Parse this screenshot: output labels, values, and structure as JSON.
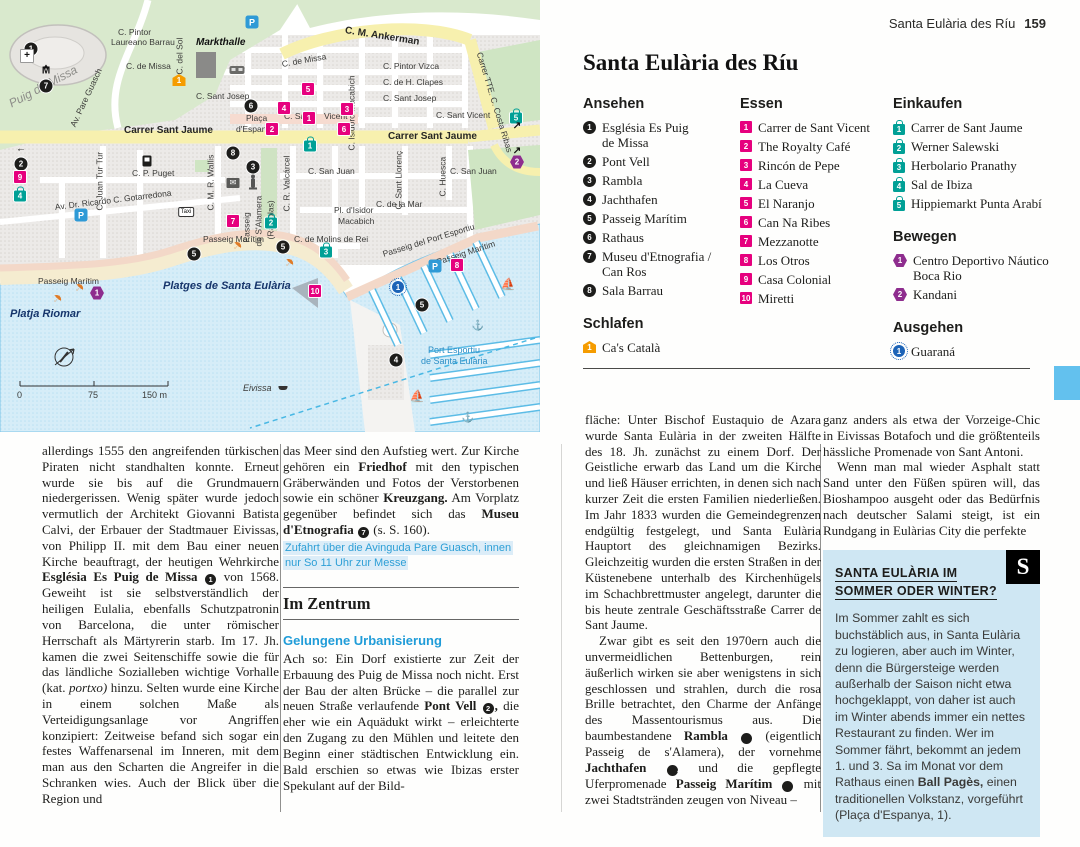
{
  "header": {
    "title": "Santa Eulària des Ríu",
    "page": "159"
  },
  "section_title": "Santa Eulària des Ríu",
  "colors": {
    "sight": "#1d1d1b",
    "food": "#e6007e",
    "shop": "#00a096",
    "sleep": "#f59c00",
    "move": "#8e2d8e",
    "go": "#1c63b7",
    "heading_blue": "#1f9cd8",
    "box_bg": "#cfe7f3",
    "edge_tab": "#63c1ee",
    "street_yellow": "#f7f0ae"
  },
  "lists": {
    "ansehen": {
      "title": "Ansehen",
      "type": "sight",
      "items": [
        {
          "n": "1",
          "lines": [
            "Església Es Puig",
            "de Missa"
          ]
        },
        {
          "n": "2",
          "lines": [
            "Pont Vell"
          ]
        },
        {
          "n": "3",
          "lines": [
            "Rambla"
          ]
        },
        {
          "n": "4",
          "lines": [
            "Jachthafen"
          ]
        },
        {
          "n": "5",
          "lines": [
            "Passeig Marítim"
          ]
        },
        {
          "n": "6",
          "lines": [
            "Rathaus"
          ]
        },
        {
          "n": "7",
          "lines": [
            "Museu d'Etnografia /",
            "Can Ros"
          ]
        },
        {
          "n": "8",
          "lines": [
            "Sala Barrau"
          ]
        }
      ]
    },
    "essen": {
      "title": "Essen",
      "type": "food",
      "items": [
        {
          "n": "1",
          "lines": [
            "Carrer de Sant Vicent"
          ]
        },
        {
          "n": "2",
          "lines": [
            "The Royalty Café"
          ]
        },
        {
          "n": "3",
          "lines": [
            "Rincón de Pepe"
          ]
        },
        {
          "n": "4",
          "lines": [
            "La Cueva"
          ]
        },
        {
          "n": "5",
          "lines": [
            "El Naranjo"
          ]
        },
        {
          "n": "6",
          "lines": [
            "Can Na Ribes"
          ]
        },
        {
          "n": "7",
          "lines": [
            "Mezzanotte"
          ]
        },
        {
          "n": "8",
          "lines": [
            "Los Otros"
          ]
        },
        {
          "n": "9",
          "lines": [
            "Casa Colonial"
          ]
        },
        {
          "n": "10",
          "lines": [
            "Miretti"
          ]
        }
      ]
    },
    "einkaufen": {
      "title": "Einkaufen",
      "type": "shop",
      "items": [
        {
          "n": "1",
          "lines": [
            "Carrer de Sant Jaume"
          ]
        },
        {
          "n": "2",
          "lines": [
            "Werner Salewski"
          ]
        },
        {
          "n": "3",
          "lines": [
            "Herbolario Pranathy"
          ]
        },
        {
          "n": "4",
          "lines": [
            "Sal de Ibiza"
          ]
        },
        {
          "n": "5",
          "lines": [
            "Hippiemarkt Punta Arabí"
          ]
        }
      ]
    },
    "schlafen": {
      "title": "Schlafen",
      "type": "sleep",
      "items": [
        {
          "n": "1",
          "lines": [
            "Ca's Català"
          ]
        }
      ]
    },
    "bewegen": {
      "title": "Bewegen",
      "type": "move",
      "items": [
        {
          "n": "1",
          "lines": [
            "Centro Deportivo Náutico",
            "Boca Rio"
          ]
        },
        {
          "n": "2",
          "lines": [
            "Kandani"
          ]
        }
      ]
    },
    "ausgehen": {
      "title": "Ausgehen",
      "type": "go",
      "items": [
        {
          "n": "1",
          "lines": [
            "Guaraná"
          ]
        }
      ]
    }
  },
  "body": {
    "col1": [
      {
        "t": "allerdings 1555 den angreifenden türkischen Piraten nicht standhalten konnte. Erneut wurde sie bis auf die Grundmauern niedergerissen. Wenig später wurde jedoch vermutlich der Architekt Giovanni Batista Calvi, der Erbauer der Stadtmauer Eivissas, von Philipp II. mit dem Bau einer neuen Kirche beauftragt, der heutigen Wehrkirche "
      },
      {
        "t": "Església Es Puig de Missa",
        "b": 1
      },
      {
        "t": " "
      },
      {
        "badge": "1"
      },
      {
        "t": " von 1568. Geweiht ist sie selbstverständlich der heiligen Eulalia, ebenfalls Schutzpatronin von Barcelona, die unter römischer Herrschaft als Märtyrerin starb. Im 17. Jh. kamen die zwei Seitenschiffe sowie die für das ländliche Sozialleben wichtige Vorhalle (kat. "
      },
      {
        "t": "portxo)",
        "i": 1
      },
      {
        "t": " hinzu. Selten wurde eine Kirche in einem solchen Maße als Verteidigungsanlage vor Angriffen konzipiert: Zeitweise befand sich sogar ein festes Waffenarsenal im Inneren, mit dem man aus den Scharten die Angreifer in die Schranken wies. Auch der Blick über die Region und"
      }
    ],
    "col2_para1": [
      {
        "t": "das Meer sind den Aufstieg wert. Zur Kirche gehören ein "
      },
      {
        "t": "Friedhof",
        "b": 1
      },
      {
        "t": " mit den typischen Gräberwänden und Fotos der Verstorbenen sowie ein schöner "
      },
      {
        "t": "Kreuzgang.",
        "b": 1
      },
      {
        "t": " Am Vorplatz gegenüber befindet sich das "
      },
      {
        "t": "Museu d'Etnografia",
        "b": 1
      },
      {
        "t": " "
      },
      {
        "badge": "7"
      },
      {
        "t": " (s. S. 160)."
      }
    ],
    "col2_info": "Zufahrt über die Avinguda Pare Guasch, innen nur So 11 Uhr zur Messe",
    "col2_heading": "Im Zentrum",
    "col2_subheading": "Gelungene Urbanisierung",
    "col2_para2": [
      {
        "t": "Ach so: Ein Dorf existierte zur Zeit der Erbauung des Puig de Missa noch nicht. Erst der Bau der alten Brücke – die parallel zur neuen Straße verlaufende "
      },
      {
        "t": "Pont Vell",
        "b": 1
      },
      {
        "t": " "
      },
      {
        "badge": "2"
      },
      {
        "t": ",",
        "b": 1
      },
      {
        "t": " die eher wie ein Aquädukt wirkt – erleichterte den Zugang zu den Mühlen und leitete den Beginn einer städtischen Entwicklung ein. Bald erschien so etwas wie Ibizas erster Spekulant auf der Bild-"
      }
    ],
    "col3_para1": [
      {
        "t": "fläche: Unter Bischof Eustaquio de Azara wurde Santa Eulària in der zweiten Hälfte des 18. Jh. zunächst zu einem Dorf. Der Geistliche erwarb das Land um die Kirche und ließ Häuser errichten, in denen sich nach kurzer Zeit die ersten Familien niederließen. Im Jahr 1833 wurden die Gemeindegrenzen endgültig festgelegt, und Santa Eulària Hauptort des gleichnamigen Bezirks. Gleichzeitig wurden die ersten Straßen in der Küstenebene unterhalb des Kirchenhügels im Schachbrettmuster angelegt, darunter die bis heute zentrale Geschäftsstraße Carrer de Sant Jaume."
      }
    ],
    "col3_para2": [
      {
        "t": "Zwar gibt es seit den 1970ern auch die unvermeidlichen Bettenburgen, rein äußerlich wirken sie aber wenigstens in sich geschlossen und strahlen, durch die rosa Brille betrachtet, den Charme der Anfänge des Massentourismus aus. Die baumbestandene "
      },
      {
        "t": "Rambla",
        "b": 1
      },
      {
        "t": " "
      },
      {
        "badge": "3"
      },
      {
        "t": " (eigentlich Passeig de s'Alamera), der vornehme "
      },
      {
        "t": "Jachthafen",
        "b": 1
      },
      {
        "t": " "
      },
      {
        "badge": "4"
      },
      {
        "t": " und die gepflegte Uferpromenade "
      },
      {
        "t": "Passeig Marítim",
        "b": 1
      },
      {
        "t": " "
      },
      {
        "badge": "5"
      },
      {
        "t": " mit zwei Stadtstränden zeugen von Niveau –"
      }
    ],
    "col4_para1": [
      {
        "t": "ganz anders als etwa der Vorzeige-Chic in Eivissas Botafoch und die größtenteils hässliche Promenade von Sant Antoni."
      }
    ],
    "col4_para2": [
      {
        "t": "Wenn man mal wieder Asphalt statt Sand unter den Füßen spüren will, das Bioshampoo ausgeht oder das Bedürfnis nach deutscher Salami steigt, ist ein Rundgang in Eulàrias City die perfekte"
      }
    ]
  },
  "box": {
    "badge": "S",
    "title1": "SANTA EULÀRIA IM",
    "title2": "SOMMER ODER WINTER?",
    "runs": [
      {
        "t": "Im Sommer zahlt es sich buchstäblich aus, in Santa Eulària zu logieren, aber auch im Winter, denn die Bürgersteige werden außerhalb der Saison nicht etwa hochgeklappt, von daher ist auch im Winter abends immer ein nettes Restaurant zu finden. Wer im Sommer fährt, bekommt an jedem 1. und 3. Sa im Monat vor dem Rathaus einen "
      },
      {
        "t": "Ball Pagès,",
        "b": 1
      },
      {
        "t": " einen traditionellen Volkstanz, vorgeführt (Plaça d'Espanya, 1)."
      }
    ]
  },
  "map": {
    "labels": [
      {
        "t": "C. Pintor",
        "x": 118,
        "y": 28
      },
      {
        "t": "Laureano Barrau",
        "x": 111,
        "y": 38
      },
      {
        "t": "Markthalle",
        "x": 196,
        "y": 38,
        "c": "mark"
      },
      {
        "t": "C. de Missa",
        "x": 126,
        "y": 62
      },
      {
        "t": "C. del Sol",
        "x": 180,
        "y": 70,
        "r": -90
      },
      {
        "t": "C. de Missa",
        "x": 282,
        "y": 60,
        "r": -10
      },
      {
        "t": "C. Sant Josep",
        "x": 196,
        "y": 92
      },
      {
        "t": "Puig de Missa",
        "x": 10,
        "y": 100,
        "r": -28,
        "c": "hill"
      },
      {
        "t": "Av. Pare Guasch",
        "x": 73,
        "y": 122,
        "r": -65
      },
      {
        "t": "Carrer Sant Jaume",
        "x": 124,
        "y": 126,
        "c": "bold"
      },
      {
        "t": "Plaça",
        "x": 246,
        "y": 114
      },
      {
        "t": "d'Espanya",
        "x": 236,
        "y": 125
      },
      {
        "t": "C. P. Puget",
        "x": 132,
        "y": 169
      },
      {
        "t": "C. Juan Tur Tur",
        "x": 100,
        "y": 206,
        "r": -90
      },
      {
        "t": "C. M. R. Wallis",
        "x": 211,
        "y": 206,
        "r": -90
      },
      {
        "t": "C. Sant",
        "x": 284,
        "y": 112
      },
      {
        "t": "Vicent",
        "x": 324,
        "y": 112
      },
      {
        "t": "C. Pintor Vizca",
        "x": 383,
        "y": 62
      },
      {
        "t": "C. de H. Clapes",
        "x": 383,
        "y": 78
      },
      {
        "t": "C. Sant Josep",
        "x": 383,
        "y": 94
      },
      {
        "t": "C. Sant Vicent",
        "x": 436,
        "y": 111
      },
      {
        "t": "C. M. Ankerman",
        "x": 345,
        "y": 26,
        "r": 9,
        "c": "bold"
      },
      {
        "t": "Carrer TTE. C. Costa Ribas",
        "x": 479,
        "y": 48,
        "r": 73
      },
      {
        "t": "C. Isidoro Macabich",
        "x": 352,
        "y": 146,
        "r": -90
      },
      {
        "t": "Carrer Sant Jaume",
        "x": 388,
        "y": 132,
        "c": "bold"
      },
      {
        "t": "C. R. Valcárcel",
        "x": 287,
        "y": 207,
        "r": -90
      },
      {
        "t": "C. San Juan",
        "x": 308,
        "y": 167
      },
      {
        "t": "C. San Juan",
        "x": 450,
        "y": 167
      },
      {
        "t": "C. Huesca",
        "x": 443,
        "y": 192,
        "r": -90
      },
      {
        "t": "C. Sant Llorenç",
        "x": 399,
        "y": 205,
        "r": -90
      },
      {
        "t": "C. de la Mar",
        "x": 376,
        "y": 200
      },
      {
        "t": "Pl. d'Isidor",
        "x": 334,
        "y": 206
      },
      {
        "t": "Macabich",
        "x": 338,
        "y": 217
      },
      {
        "t": "Av. Dr. Ricardo C. Gotarredona",
        "x": 55,
        "y": 203,
        "r": -7
      },
      {
        "t": "Passeig",
        "x": 247,
        "y": 238,
        "r": -90
      },
      {
        "t": "de S'Alamera",
        "x": 259,
        "y": 242,
        "r": -90
      },
      {
        "t": "(Ramblas)",
        "x": 271,
        "y": 235,
        "r": -90
      },
      {
        "t": "Passeig Marítim",
        "x": 38,
        "y": 277
      },
      {
        "t": "Passeig Marítim",
        "x": 203,
        "y": 235
      },
      {
        "t": "Passeig Marítim",
        "x": 437,
        "y": 258,
        "r": -18
      },
      {
        "t": "C. de Molins de Rei",
        "x": 294,
        "y": 235
      },
      {
        "t": "Passeig del Port Esportiu",
        "x": 383,
        "y": 250,
        "r": -17
      },
      {
        "t": "Platges de Santa Eulària",
        "x": 163,
        "y": 282,
        "c": "beach"
      },
      {
        "t": "Platja Riomar",
        "x": 10,
        "y": 310,
        "c": "beach"
      },
      {
        "t": "Port Esportiu",
        "x": 428,
        "y": 346,
        "c": "port"
      },
      {
        "t": "de Santa Eulària",
        "x": 421,
        "y": 357,
        "c": "port"
      },
      {
        "t": "Eivissa",
        "x": 243,
        "y": 384,
        "c": "it"
      },
      {
        "t": "0",
        "x": 17,
        "y": 391,
        "c": "scale"
      },
      {
        "t": "75",
        "x": 88,
        "y": 391,
        "c": "scale"
      },
      {
        "t": "150 m",
        "x": 142,
        "y": 391,
        "c": "scale"
      }
    ],
    "markers": [
      {
        "k": "sight",
        "n": "1",
        "x": 31,
        "y": 49
      },
      {
        "k": "sight",
        "n": "7",
        "x": 46,
        "y": 86
      },
      {
        "k": "sight",
        "n": "6",
        "x": 251,
        "y": 106
      },
      {
        "k": "sight",
        "n": "8",
        "x": 233,
        "y": 153
      },
      {
        "k": "sight",
        "n": "3",
        "x": 253,
        "y": 167
      },
      {
        "k": "sight",
        "n": "2",
        "x": 21,
        "y": 164
      },
      {
        "k": "sight",
        "n": "5",
        "x": 194,
        "y": 254
      },
      {
        "k": "sight",
        "n": "5",
        "x": 283,
        "y": 247
      },
      {
        "k": "sight",
        "n": "5",
        "x": 422,
        "y": 305
      },
      {
        "k": "sight",
        "n": "4",
        "x": 396,
        "y": 360
      },
      {
        "k": "food",
        "n": "1",
        "x": 309,
        "y": 118
      },
      {
        "k": "food",
        "n": "2",
        "x": 272,
        "y": 129
      },
      {
        "k": "food",
        "n": "3",
        "x": 347,
        "y": 109
      },
      {
        "k": "food",
        "n": "4",
        "x": 284,
        "y": 108
      },
      {
        "k": "food",
        "n": "5",
        "x": 308,
        "y": 89
      },
      {
        "k": "food",
        "n": "6",
        "x": 344,
        "y": 129
      },
      {
        "k": "food",
        "n": "7",
        "x": 233,
        "y": 221
      },
      {
        "k": "food",
        "n": "8",
        "x": 457,
        "y": 265
      },
      {
        "k": "food",
        "n": "9",
        "x": 20,
        "y": 177
      },
      {
        "k": "food",
        "n": "10",
        "x": 315,
        "y": 291
      },
      {
        "k": "shop",
        "n": "1",
        "x": 310,
        "y": 143
      },
      {
        "k": "shop",
        "n": "2",
        "x": 271,
        "y": 220
      },
      {
        "k": "shop",
        "n": "3",
        "x": 326,
        "y": 249
      },
      {
        "k": "shop",
        "n": "4",
        "x": 20,
        "y": 193
      },
      {
        "k": "shop",
        "n": "5",
        "x": 516,
        "y": 115
      },
      {
        "k": "sleep",
        "n": "1",
        "x": 179,
        "y": 80
      },
      {
        "k": "move",
        "n": "1",
        "x": 97,
        "y": 293
      },
      {
        "k": "move",
        "n": "2",
        "x": 517,
        "y": 162
      },
      {
        "k": "go",
        "n": "1",
        "x": 398,
        "y": 287
      }
    ],
    "icons": [
      {
        "k": "parking",
        "x": 252,
        "y": 22
      },
      {
        "k": "parking",
        "x": 81,
        "y": 215
      },
      {
        "k": "parking",
        "x": 435,
        "y": 266
      },
      {
        "k": "monument",
        "x": 46,
        "y": 71
      },
      {
        "k": "church",
        "x": 27,
        "y": 56
      },
      {
        "k": "bus",
        "x": 237,
        "y": 59
      },
      {
        "k": "taxi",
        "x": 186,
        "y": 212
      },
      {
        "k": "mail",
        "x": 233,
        "y": 183
      },
      {
        "k": "fuel",
        "x": 147,
        "y": 142
      },
      {
        "k": "statue",
        "x": 253,
        "y": 153
      },
      {
        "k": "umbrella",
        "x": 57,
        "y": 299
      },
      {
        "k": "umbrella",
        "x": 79,
        "y": 288
      },
      {
        "k": "umbrella",
        "x": 237,
        "y": 246
      },
      {
        "k": "umbrella",
        "x": 289,
        "y": 263
      },
      {
        "k": "sailboat",
        "x": 508,
        "y": 284
      },
      {
        "k": "sailboat",
        "x": 417,
        "y": 396
      },
      {
        "k": "anchor",
        "x": 478,
        "y": 326
      },
      {
        "k": "anchor",
        "x": 468,
        "y": 418
      },
      {
        "k": "boat",
        "x": 283,
        "y": 388
      },
      {
        "k": "arrow-left",
        "x": 21,
        "y": 149
      },
      {
        "k": "arrow-ne",
        "x": 517,
        "y": 126
      },
      {
        "k": "arrow-ne",
        "x": 517,
        "y": 151
      }
    ]
  }
}
